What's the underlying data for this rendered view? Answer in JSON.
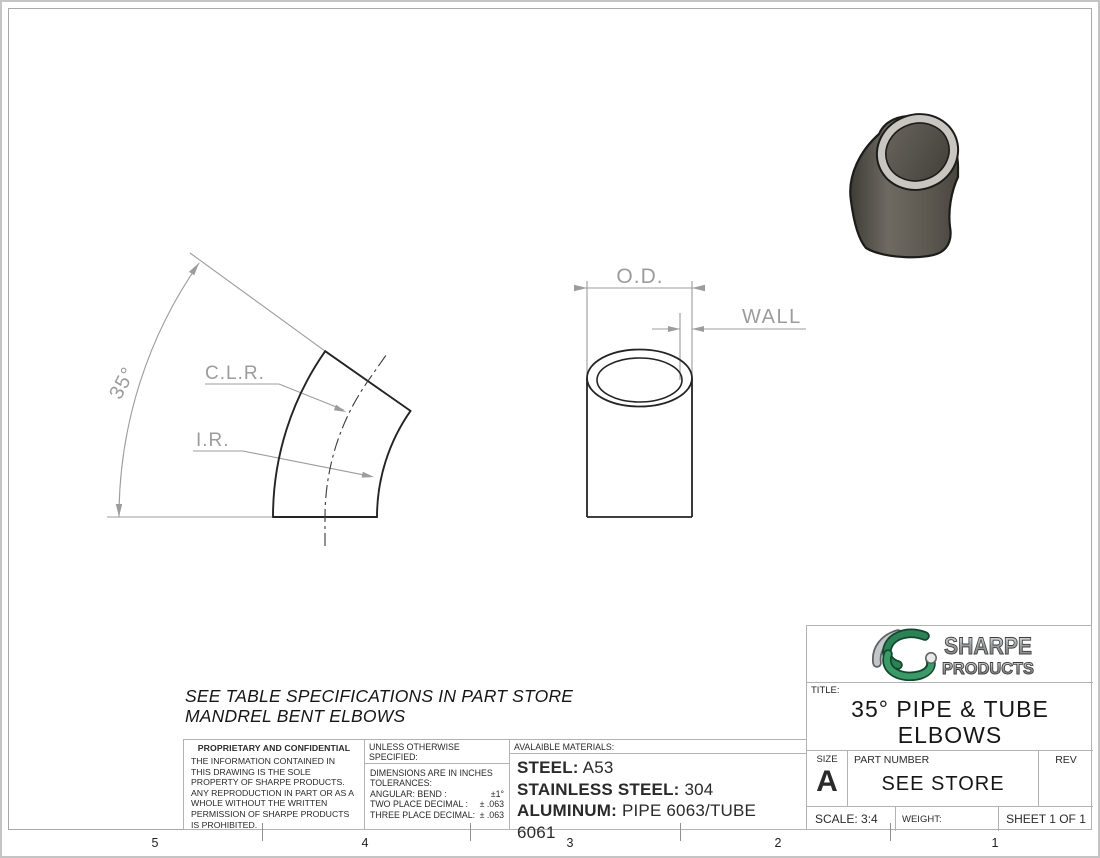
{
  "colors": {
    "outline_ink": "#1f1f1f",
    "dimension_gray": "#9c9c9c",
    "border_gray": "#b2b2b2",
    "brand_green_dark": "#1e6b45",
    "brand_green": "#2c8157",
    "brand_silver": "#bfc2c4",
    "render_body_dark": "#45423b",
    "render_body_light": "#6e6a62",
    "render_rim": "#c9c6c1"
  },
  "views": {
    "side_view": {
      "angle_label": "35°",
      "clr_label": "C.L.R.",
      "ir_label": "I.R."
    },
    "end_view": {
      "od_label": "O.D.",
      "wall_label": "WALL"
    }
  },
  "note": {
    "line1": "SEE TABLE SPECIFICATIONS IN PART STORE",
    "line2": "MANDREL BENT ELBOWS"
  },
  "proprietary": {
    "heading": "PROPRIETARY AND CONFIDENTIAL",
    "body": "THE INFORMATION CONTAINED IN THIS DRAWING IS THE SOLE PROPERTY OF SHARPE PRODUCTS.  ANY REPRODUCTION IN PART OR AS A WHOLE WITHOUT THE WRITTEN PERMISSION OF SHARPE PRODUCTS IS PROHIBITED."
  },
  "tolerances": {
    "heading": "UNLESS OTHERWISE SPECIFIED:",
    "dims_note": "DIMENSIONS ARE IN INCHES",
    "tol_note": "TOLERANCES:",
    "rows": [
      {
        "label": "ANGULAR: BEND :",
        "value": "±1°"
      },
      {
        "label": "TWO PLACE DECIMAL  :",
        "value": "± .063"
      },
      {
        "label": "THREE PLACE DECIMAL:",
        "value": "± .063"
      }
    ]
  },
  "materials": {
    "heading": "AVALAIBLE MATERIALS:",
    "rows": [
      {
        "label": "STEEL:",
        "value": "A53"
      },
      {
        "label": "STAINLESS STEEL:",
        "value": "304"
      },
      {
        "label": "ALUMINUM:",
        "value": "PIPE 6063/TUBE 6061"
      }
    ]
  },
  "title_block": {
    "brand_line1": "SHARPE",
    "brand_line2": "PRODUCTS",
    "title_label": "TITLE:",
    "title_line1": "35° PIPE & TUBE",
    "title_line2": "ELBOWS",
    "size_label": "SIZE",
    "size_value": "A",
    "part_label": "PART NUMBER",
    "part_value": "SEE STORE",
    "rev_label": "REV",
    "scale": "SCALE: 3:4",
    "weight_label": "WEIGHT:",
    "sheet": "SHEET 1 OF 1"
  },
  "zone_numbers": [
    "5",
    "4",
    "3",
    "2",
    "1"
  ]
}
